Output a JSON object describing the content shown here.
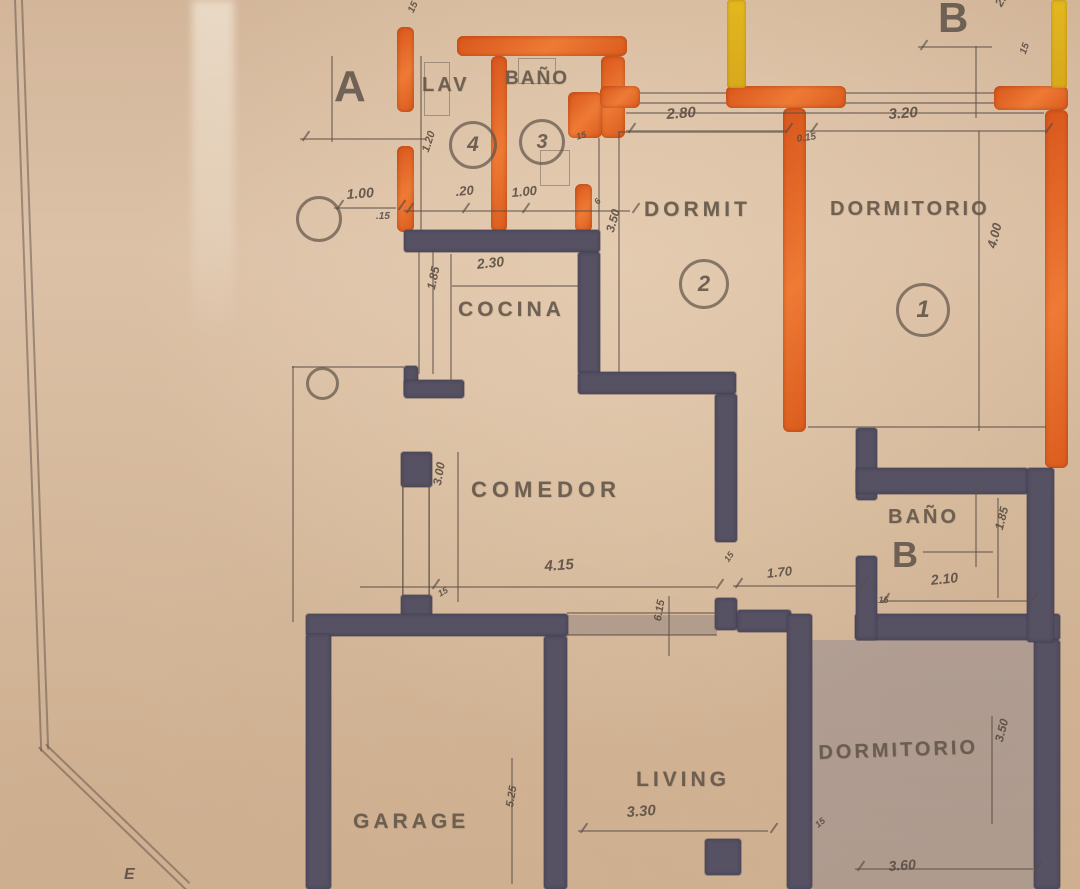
{
  "palette": {
    "paper": "#d9bda1",
    "wall_dark": "#565264",
    "wall_orange": "#e2601f",
    "wall_yellow": "#ddb21e",
    "pencil": "#5e4f47",
    "wash_blue": "rgba(104,106,140,0.30)"
  },
  "plan": {
    "washes": [
      {
        "x": 812,
        "y": 640,
        "w": 222,
        "h": 249,
        "c": "blue"
      },
      {
        "x": 567,
        "y": 615,
        "w": 150,
        "h": 20,
        "c": "gray"
      }
    ],
    "walls": [
      {
        "x": 397,
        "y": 27,
        "w": 17,
        "h": 85,
        "c": "orange"
      },
      {
        "x": 397,
        "y": 146,
        "w": 17,
        "h": 86,
        "c": "orange"
      },
      {
        "x": 457,
        "y": 36,
        "w": 170,
        "h": 20,
        "c": "orange"
      },
      {
        "x": 491,
        "y": 56,
        "w": 16,
        "h": 176,
        "c": "orange"
      },
      {
        "x": 601,
        "y": 56,
        "w": 24,
        "h": 82,
        "c": "orange"
      },
      {
        "x": 568,
        "y": 92,
        "w": 34,
        "h": 46,
        "c": "orange"
      },
      {
        "x": 575,
        "y": 184,
        "w": 17,
        "h": 48,
        "c": "orange"
      },
      {
        "x": 600,
        "y": 86,
        "w": 40,
        "h": 22,
        "c": "orange"
      },
      {
        "x": 726,
        "y": 86,
        "w": 120,
        "h": 22,
        "c": "orange"
      },
      {
        "x": 783,
        "y": 108,
        "w": 23,
        "h": 324,
        "c": "orange"
      },
      {
        "x": 994,
        "y": 86,
        "w": 74,
        "h": 24,
        "c": "orange"
      },
      {
        "x": 1045,
        "y": 110,
        "w": 23,
        "h": 358,
        "c": "orange"
      },
      {
        "x": 727,
        "y": 0,
        "w": 19,
        "h": 88,
        "c": "yellow"
      },
      {
        "x": 1051,
        "y": 0,
        "w": 16,
        "h": 88,
        "c": "yellow"
      },
      {
        "x": 404,
        "y": 230,
        "w": 196,
        "h": 22,
        "c": "dark"
      },
      {
        "x": 578,
        "y": 252,
        "w": 22,
        "h": 122,
        "c": "dark"
      },
      {
        "x": 578,
        "y": 372,
        "w": 158,
        "h": 22,
        "c": "dark"
      },
      {
        "x": 715,
        "y": 394,
        "w": 22,
        "h": 148,
        "c": "dark"
      },
      {
        "x": 715,
        "y": 598,
        "w": 22,
        "h": 32,
        "c": "dark"
      },
      {
        "x": 737,
        "y": 610,
        "w": 54,
        "h": 22,
        "c": "dark"
      },
      {
        "x": 404,
        "y": 366,
        "w": 14,
        "h": 30,
        "c": "dark"
      },
      {
        "x": 404,
        "y": 380,
        "w": 60,
        "h": 18,
        "c": "dark"
      },
      {
        "x": 401,
        "y": 452,
        "w": 31,
        "h": 35,
        "c": "dark"
      },
      {
        "x": 401,
        "y": 595,
        "w": 31,
        "h": 25,
        "c": "dark"
      },
      {
        "x": 306,
        "y": 614,
        "w": 262,
        "h": 22,
        "c": "dark"
      },
      {
        "x": 306,
        "y": 634,
        "w": 25,
        "h": 255,
        "c": "dark"
      },
      {
        "x": 544,
        "y": 636,
        "w": 23,
        "h": 253,
        "c": "dark"
      },
      {
        "x": 787,
        "y": 614,
        "w": 25,
        "h": 275,
        "c": "dark"
      },
      {
        "x": 855,
        "y": 614,
        "w": 205,
        "h": 26,
        "c": "dark"
      },
      {
        "x": 1034,
        "y": 640,
        "w": 26,
        "h": 249,
        "c": "dark"
      },
      {
        "x": 856,
        "y": 428,
        "w": 21,
        "h": 72,
        "c": "dark"
      },
      {
        "x": 856,
        "y": 468,
        "w": 172,
        "h": 26,
        "c": "dark"
      },
      {
        "x": 1027,
        "y": 468,
        "w": 27,
        "h": 174,
        "c": "dark"
      },
      {
        "x": 856,
        "y": 556,
        "w": 21,
        "h": 84,
        "c": "dark"
      },
      {
        "x": 705,
        "y": 839,
        "w": 36,
        "h": 36,
        "c": "dark"
      }
    ],
    "lines": [
      {
        "o": "h",
        "x": 640,
        "y": 92,
        "l": 86
      },
      {
        "o": "h",
        "x": 640,
        "y": 102,
        "l": 86
      },
      {
        "o": "h",
        "x": 846,
        "y": 92,
        "l": 148
      },
      {
        "o": "h",
        "x": 846,
        "y": 102,
        "l": 148
      },
      {
        "o": "h",
        "x": 626,
        "y": 112,
        "l": 418
      },
      {
        "o": "h",
        "x": 626,
        "y": 130,
        "l": 160
      },
      {
        "o": "h",
        "x": 806,
        "y": 130,
        "l": 240
      },
      {
        "o": "v",
        "x": 975,
        "y": 46,
        "l": 72
      },
      {
        "o": "h",
        "x": 918,
        "y": 46,
        "l": 74
      },
      {
        "o": "v",
        "x": 331,
        "y": 56,
        "l": 86
      },
      {
        "o": "h",
        "x": 300,
        "y": 138,
        "l": 126
      },
      {
        "o": "h",
        "x": 334,
        "y": 207,
        "l": 62
      },
      {
        "o": "h",
        "x": 404,
        "y": 210,
        "l": 226
      },
      {
        "o": "v",
        "x": 420,
        "y": 56,
        "l": 174
      },
      {
        "o": "v",
        "x": 598,
        "y": 138,
        "l": 94
      },
      {
        "o": "v",
        "x": 418,
        "y": 252,
        "l": 122
      },
      {
        "o": "v",
        "x": 432,
        "y": 252,
        "l": 122
      },
      {
        "o": "h",
        "x": 452,
        "y": 285,
        "l": 126
      },
      {
        "o": "v",
        "x": 450,
        "y": 254,
        "l": 138
      },
      {
        "o": "v",
        "x": 618,
        "y": 132,
        "l": 242
      },
      {
        "o": "h",
        "x": 618,
        "y": 131,
        "l": 166
      },
      {
        "o": "v",
        "x": 978,
        "y": 131,
        "l": 300
      },
      {
        "o": "h",
        "x": 808,
        "y": 426,
        "l": 238
      },
      {
        "o": "v",
        "x": 457,
        "y": 452,
        "l": 150
      },
      {
        "o": "v",
        "x": 402,
        "y": 484,
        "l": 112
      },
      {
        "o": "v",
        "x": 428,
        "y": 484,
        "l": 112
      },
      {
        "o": "h",
        "x": 360,
        "y": 586,
        "l": 356
      },
      {
        "o": "h",
        "x": 733,
        "y": 585,
        "l": 126
      },
      {
        "o": "h",
        "x": 880,
        "y": 600,
        "l": 148
      },
      {
        "o": "h",
        "x": 923,
        "y": 551,
        "l": 70
      },
      {
        "o": "v",
        "x": 975,
        "y": 483,
        "l": 84
      },
      {
        "o": "v",
        "x": 997,
        "y": 498,
        "l": 100
      },
      {
        "o": "h",
        "x": 567,
        "y": 612,
        "l": 150
      },
      {
        "o": "h",
        "x": 567,
        "y": 634,
        "l": 150
      },
      {
        "o": "v",
        "x": 668,
        "y": 596,
        "l": 60
      },
      {
        "o": "h",
        "x": 578,
        "y": 830,
        "l": 190
      },
      {
        "o": "v",
        "x": 511,
        "y": 758,
        "l": 126
      },
      {
        "o": "h",
        "x": 855,
        "y": 868,
        "l": 178
      },
      {
        "o": "v",
        "x": 991,
        "y": 716,
        "l": 108
      },
      {
        "o": "v",
        "x": 292,
        "y": 366,
        "l": 256
      },
      {
        "o": "h",
        "x": 292,
        "y": 366,
        "l": 112
      },
      {
        "o": "v",
        "x": 14,
        "y": 0,
        "l": 752,
        "r": -2
      },
      {
        "o": "v",
        "x": 21,
        "y": 0,
        "l": 750,
        "r": -2
      },
      {
        "o": "v",
        "x": 38,
        "y": 748,
        "l": 205,
        "r": -46
      },
      {
        "o": "v",
        "x": 45,
        "y": 745,
        "l": 200,
        "r": -46
      }
    ],
    "rects": [
      {
        "x": 424,
        "y": 62,
        "w": 24,
        "h": 52
      },
      {
        "x": 518,
        "y": 58,
        "w": 36,
        "h": 24
      },
      {
        "x": 540,
        "y": 150,
        "w": 28,
        "h": 34
      },
      {
        "x": 402,
        "y": 484,
        "w": 26,
        "h": 110
      }
    ],
    "ticks": [
      [
        334,
        204
      ],
      [
        396,
        204
      ],
      [
        404,
        207
      ],
      [
        460,
        207
      ],
      [
        520,
        207
      ],
      [
        630,
        207
      ],
      [
        626,
        127
      ],
      [
        783,
        127
      ],
      [
        808,
        127
      ],
      [
        1043,
        127
      ],
      [
        430,
        583
      ],
      [
        714,
        583
      ],
      [
        733,
        582
      ],
      [
        858,
        582
      ],
      [
        880,
        597
      ],
      [
        1028,
        597
      ],
      [
        855,
        865
      ],
      [
        1032,
        865
      ],
      [
        578,
        827
      ],
      [
        768,
        827
      ],
      [
        918,
        44
      ],
      [
        300,
        135
      ]
    ],
    "rings": [
      {
        "x": 296,
        "y": 196,
        "d": 40,
        "t": ""
      },
      {
        "x": 306,
        "y": 367,
        "d": 27,
        "t": ""
      },
      {
        "x": 449,
        "y": 121,
        "d": 42,
        "t": "4"
      },
      {
        "x": 519,
        "y": 119,
        "d": 40,
        "t": "3"
      },
      {
        "x": 679,
        "y": 259,
        "d": 44,
        "t": "2"
      },
      {
        "x": 896,
        "y": 283,
        "d": 48,
        "t": "1"
      }
    ],
    "texts": [
      {
        "t": "A",
        "x": 334,
        "y": 62,
        "s": 44,
        "k": "marker"
      },
      {
        "t": "B",
        "x": 938,
        "y": -6,
        "s": 42,
        "k": "marker"
      },
      {
        "t": "B",
        "x": 892,
        "y": 534,
        "s": 36,
        "k": "marker"
      },
      {
        "t": "LAV",
        "x": 422,
        "y": 74,
        "s": 20,
        "k": "room",
        "sp": 3
      },
      {
        "t": "BAÑO",
        "x": 505,
        "y": 68,
        "s": 19,
        "k": "room",
        "sp": 2
      },
      {
        "t": "DORMIT",
        "x": 644,
        "y": 198,
        "s": 21,
        "k": "room",
        "sp": 4
      },
      {
        "t": "DORMITORIO",
        "x": 830,
        "y": 198,
        "s": 20,
        "k": "room",
        "sp": 3
      },
      {
        "t": "COCINA",
        "x": 458,
        "y": 298,
        "s": 21,
        "k": "room",
        "sp": 4
      },
      {
        "t": "COMEDOR",
        "x": 471,
        "y": 477,
        "s": 22,
        "k": "room",
        "sp": 5
      },
      {
        "t": "BAÑO",
        "x": 888,
        "y": 506,
        "s": 20,
        "k": "room",
        "sp": 3
      },
      {
        "t": "DORMITORIO",
        "x": 818,
        "y": 742,
        "s": 20,
        "k": "room",
        "sp": 3,
        "r": -2
      },
      {
        "t": "LIVING",
        "x": 636,
        "y": 768,
        "s": 21,
        "k": "room",
        "sp": 4
      },
      {
        "t": "GARAGE",
        "x": 353,
        "y": 810,
        "s": 21,
        "k": "room",
        "sp": 4
      },
      {
        "t": "1.00",
        "x": 346,
        "y": 186,
        "s": 14,
        "k": "dim",
        "r": -4
      },
      {
        "t": ".15",
        "x": 376,
        "y": 211,
        "s": 10,
        "k": "dim"
      },
      {
        "t": "15",
        "x": 406,
        "y": 10,
        "s": 10,
        "k": "dim",
        "r": -65
      },
      {
        "t": "1.20",
        "x": 420,
        "y": 150,
        "s": 11,
        "k": "dim",
        "r": -72
      },
      {
        "t": ".20",
        "x": 455,
        "y": 184,
        "s": 13,
        "k": "dim",
        "r": -5
      },
      {
        "t": "1.00",
        "x": 511,
        "y": 185,
        "s": 13,
        "k": "dim",
        "r": -5
      },
      {
        "t": "15",
        "x": 575,
        "y": 132,
        "s": 9,
        "k": "dim",
        "r": -15
      },
      {
        "t": "2.80",
        "x": 666,
        "y": 106,
        "s": 15,
        "k": "dim",
        "r": -4
      },
      {
        "t": "0.15",
        "x": 796,
        "y": 134,
        "s": 10,
        "k": "dim",
        "r": -8
      },
      {
        "t": "3.20",
        "x": 888,
        "y": 106,
        "s": 15,
        "k": "dim",
        "r": -4
      },
      {
        "t": "2.",
        "x": 992,
        "y": 2,
        "s": 12,
        "k": "dim",
        "r": -60
      },
      {
        "t": "15",
        "x": 1018,
        "y": 52,
        "s": 10,
        "k": "dim",
        "r": -70
      },
      {
        "t": "2.30",
        "x": 476,
        "y": 256,
        "s": 14,
        "k": "dim",
        "r": -6
      },
      {
        "t": "1.85",
        "x": 424,
        "y": 288,
        "s": 12,
        "k": "dim",
        "r": -78
      },
      {
        "t": "3.50",
        "x": 603,
        "y": 230,
        "s": 12,
        "k": "dim",
        "r": -74
      },
      {
        "t": "4.00",
        "x": 984,
        "y": 246,
        "s": 13,
        "k": "dim",
        "r": -76
      },
      {
        "t": "3.00",
        "x": 430,
        "y": 484,
        "s": 12,
        "k": "dim",
        "r": -80
      },
      {
        "t": "4.15",
        "x": 544,
        "y": 558,
        "s": 15,
        "k": "dim",
        "r": -4
      },
      {
        "t": "15",
        "x": 722,
        "y": 558,
        "s": 9,
        "k": "dim",
        "r": -55
      },
      {
        "t": "1.70",
        "x": 766,
        "y": 566,
        "s": 13,
        "k": "dim",
        "r": -6
      },
      {
        "t": "15",
        "x": 436,
        "y": 590,
        "s": 9,
        "k": "dim",
        "r": -30
      },
      {
        "t": "6.15",
        "x": 652,
        "y": 620,
        "s": 11,
        "k": "dim",
        "r": -80
      },
      {
        "t": "2.10",
        "x": 930,
        "y": 572,
        "s": 14,
        "k": "dim",
        "r": -6
      },
      {
        "t": "1.85",
        "x": 992,
        "y": 528,
        "s": 12,
        "k": "dim",
        "r": -76
      },
      {
        "t": ".15",
        "x": 876,
        "y": 595,
        "s": 9,
        "k": "dim"
      },
      {
        "t": "3.30",
        "x": 626,
        "y": 804,
        "s": 15,
        "k": "dim",
        "r": -4
      },
      {
        "t": "5.25",
        "x": 504,
        "y": 806,
        "s": 11,
        "k": "dim",
        "r": -80
      },
      {
        "t": "6",
        "x": 592,
        "y": 200,
        "s": 9,
        "k": "dim",
        "r": -50
      },
      {
        "t": "15",
        "x": 813,
        "y": 822,
        "s": 9,
        "k": "dim",
        "r": -40
      },
      {
        "t": "3.60",
        "x": 888,
        "y": 858,
        "s": 14,
        "k": "dim",
        "r": -4
      },
      {
        "t": "3.50",
        "x": 992,
        "y": 740,
        "s": 12,
        "k": "dim",
        "r": -76
      },
      {
        "t": "E",
        "x": 124,
        "y": 866,
        "s": 16,
        "k": "dim"
      }
    ]
  }
}
